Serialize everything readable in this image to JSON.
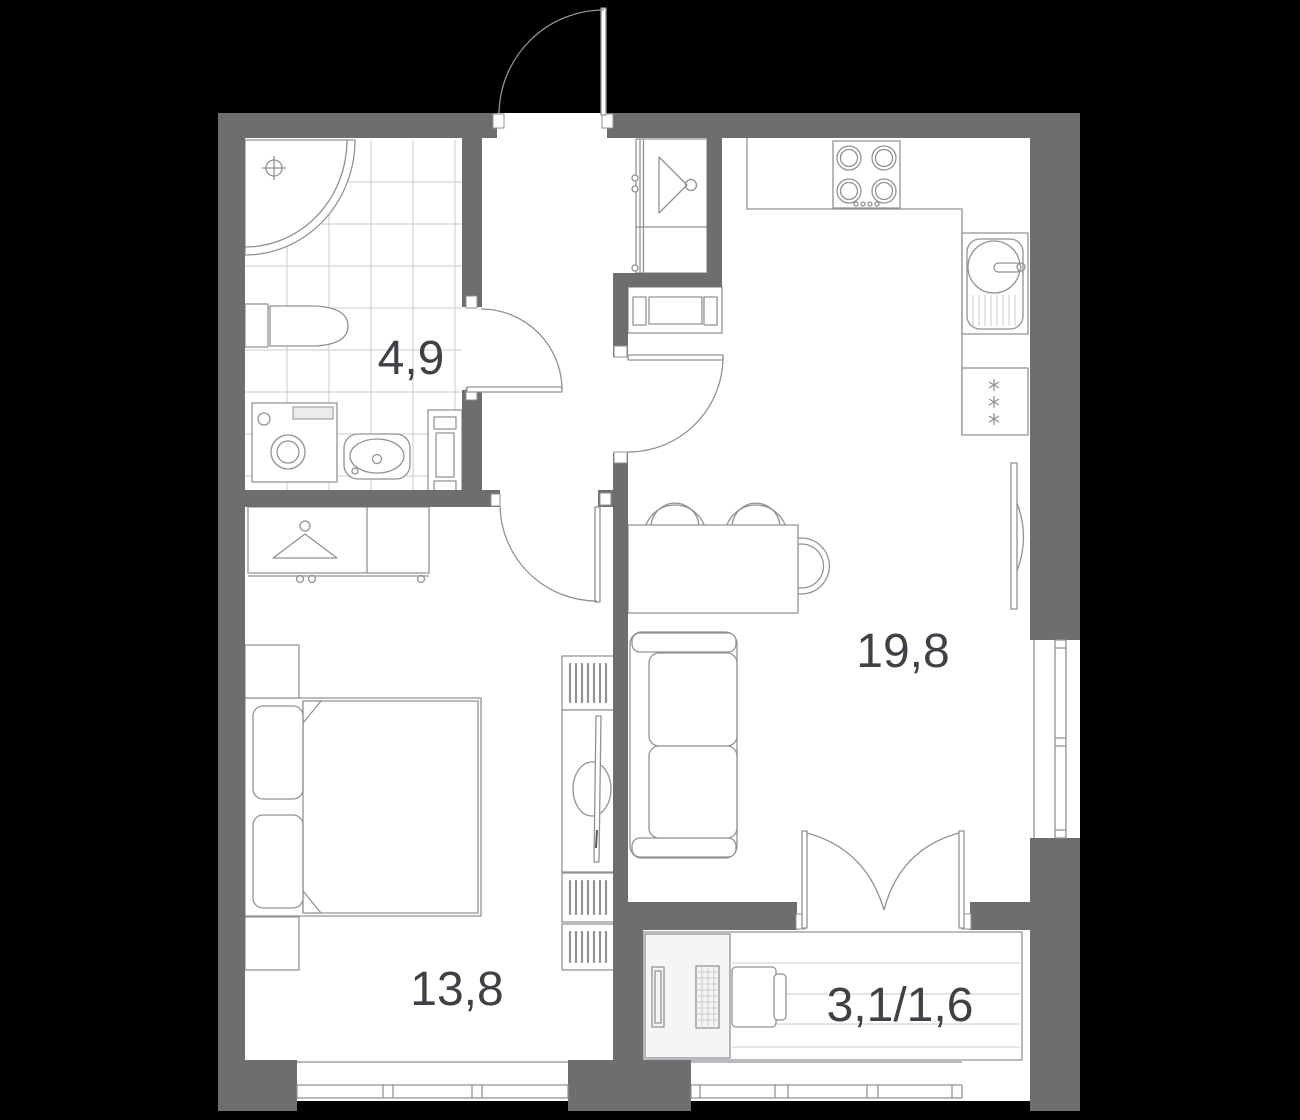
{
  "plan": {
    "type": "apartment-floor-plan",
    "labels": {
      "bathroom": "4,9",
      "kitchen_living": "19,8",
      "bedroom": "13,8",
      "balcony": "3,1/1,6"
    },
    "rooms": [
      {
        "id": "bathroom",
        "area": "4,9",
        "fixtures": [
          "corner-shower",
          "toilet",
          "washing-machine",
          "wash-basin",
          "towel-radiator",
          "tiled-floor",
          "swing-door"
        ]
      },
      {
        "id": "hallway",
        "fixtures": [
          "entrance-door",
          "closet-with-hanger"
        ]
      },
      {
        "id": "kitchen-living-room",
        "area": "19,8",
        "fixtures": [
          "cooktop-4-burners",
          "kitchen-sink",
          "refrigerator",
          "radiator-niche",
          "dining-table",
          "three-chairs",
          "sofa",
          "wall-tv",
          "swing-door",
          "window"
        ]
      },
      {
        "id": "bedroom",
        "area": "13,8",
        "fixtures": [
          "wardrobe-with-hanger",
          "double-bed",
          "two-nightstands",
          "bookshelves",
          "tv-stand",
          "swing-door",
          "window"
        ]
      },
      {
        "id": "balcony",
        "area": "3,1/1,6",
        "fixtures": [
          "storage-cabinet",
          "drying-rack",
          "chair",
          "french-doors",
          "window"
        ]
      }
    ]
  },
  "colors": {
    "background": "#000000",
    "floor": "#ffffff",
    "wall": "#6d6e70",
    "line": "#8f9296",
    "line_light": "#caccce",
    "fill_light": "#f5f5f6",
    "text": "#3e4145"
  }
}
